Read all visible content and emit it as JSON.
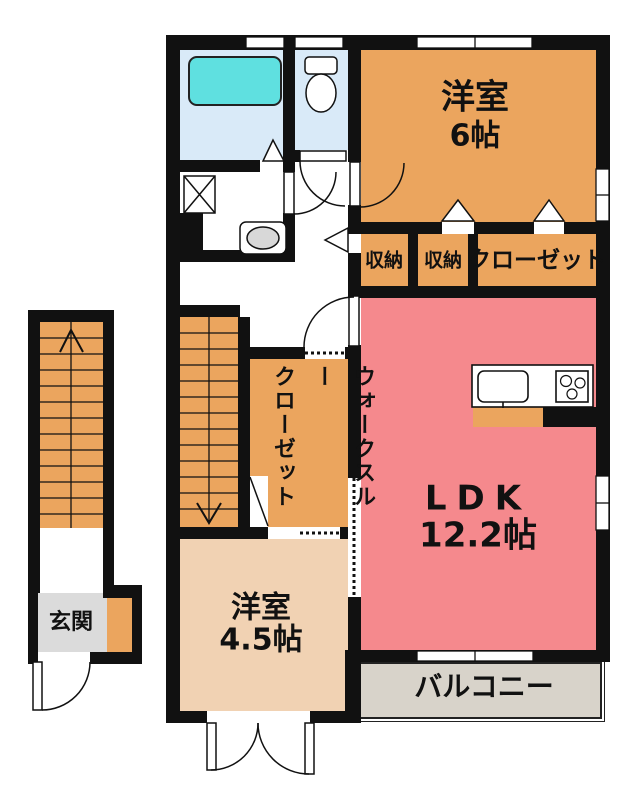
{
  "plan_title": "2F apartment floor plan",
  "colors": {
    "wall": "#111111",
    "orange": "#EBA55E",
    "peach": "#F1D2B3",
    "pink": "#F5898D",
    "bath_floor": "#D9EAF8",
    "tub": "#5FE0E0",
    "entry": "#DBDBDB",
    "balcony": "#D8D3CA",
    "basin": "#D8D8D8"
  },
  "rooms": {
    "western6": {
      "name": "洋室",
      "size": "6帖"
    },
    "storage1": {
      "label": "収納"
    },
    "storage2": {
      "label": "収納"
    },
    "closet": {
      "label": "クローゼット"
    },
    "ldk": {
      "name": "LDK",
      "size": "12.2帖"
    },
    "wtc": {
      "line1": "ウォークスルー",
      "line2": "クローゼット"
    },
    "western45": {
      "name": "洋室",
      "size": "4.5帖"
    },
    "entrance": {
      "label": "玄関"
    },
    "balcony": {
      "label": "バルコニー"
    }
  }
}
